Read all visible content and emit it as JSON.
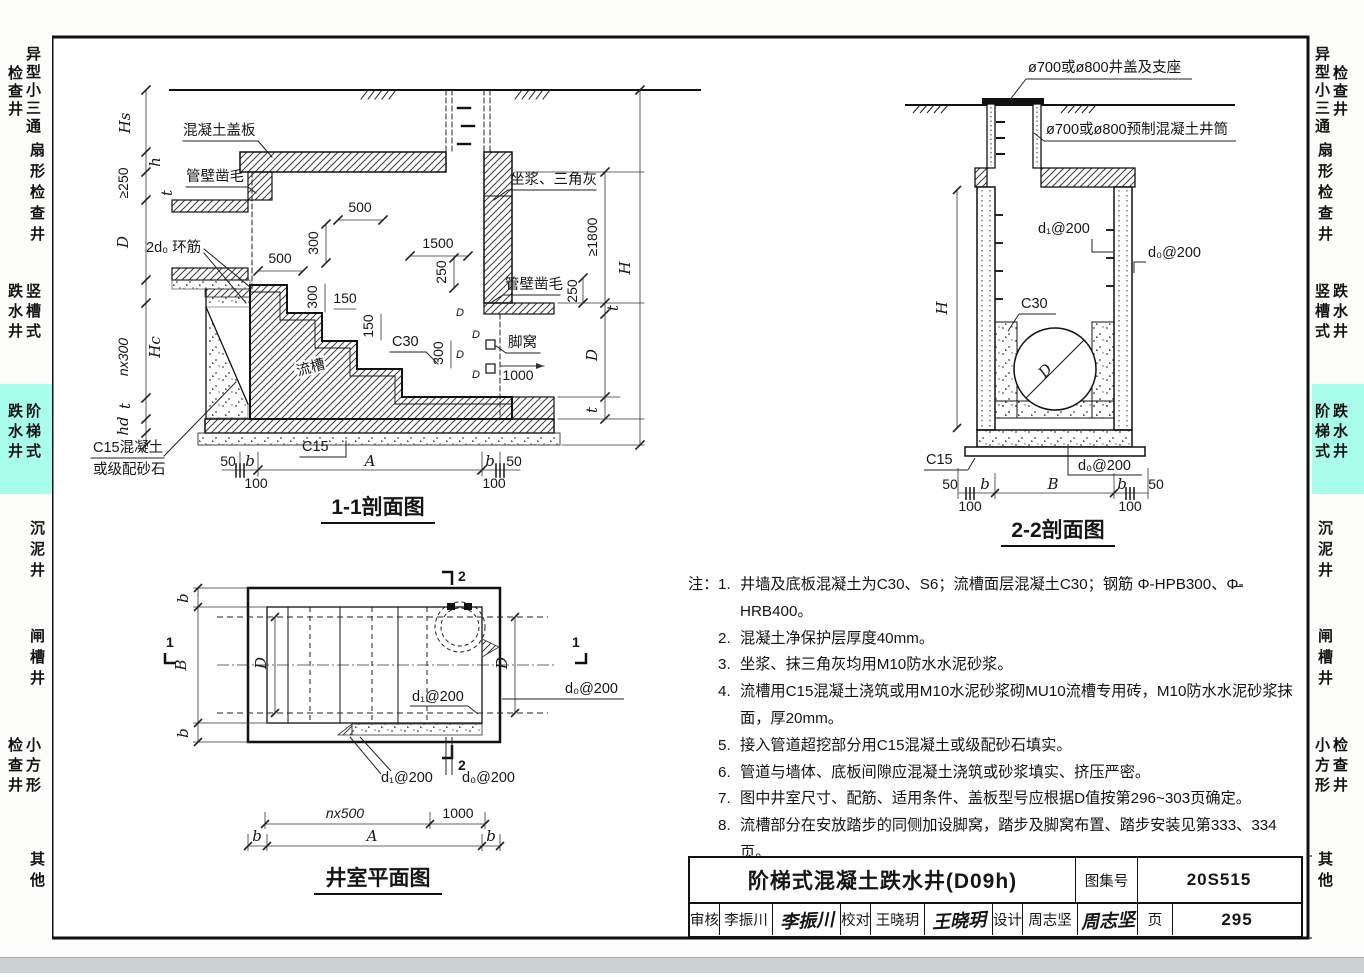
{
  "sidebar": {
    "highlight_color": "#a8fdeb",
    "groups": [
      {
        "inner": "异型小三通",
        "outer": "检查井"
      },
      {
        "inner": "扇形检查井",
        "outer": ""
      },
      {
        "inner": "竖槽式",
        "outer": "跌水井"
      },
      {
        "inner": "阶梯式",
        "outer": "跌水井"
      },
      {
        "inner": "沉泥井",
        "outer": ""
      },
      {
        "inner": "闸槽井",
        "outer": ""
      },
      {
        "inner": "小方形",
        "outer": "检查井"
      },
      {
        "inner": "其他",
        "outer": ""
      }
    ]
  },
  "dims": {
    "v50": "50",
    "v100": "100",
    "v150": "150",
    "v250": "250",
    "v300": "300",
    "v500": "500",
    "v1000": "1000",
    "v1500": "1500",
    "ge250": "≥250",
    "ge1800": "≥1800",
    "nx300": "nx300",
    "nx500": "nx500",
    "A": "A",
    "B": "B",
    "D": "D",
    "H": "H",
    "Hs": "Hs",
    "Hc": "Hc",
    "h": "h",
    "hd": "hd",
    "t": "t",
    "b": "b",
    "one": "1",
    "two": "2"
  },
  "s11": {
    "title": "1-1剖面图",
    "cover": "混凝土盖板",
    "chisel": "管壁凿毛",
    "ring": "2d₀ 环筋",
    "mortar": "坐浆、三角灰",
    "foothole": "脚窝",
    "channel": "流槽",
    "c30": "C30",
    "c15": "C15",
    "fill1": "C15混凝土",
    "fill2": "或级配砂石"
  },
  "s22": {
    "title": "2-2剖面图",
    "cap": "ø700或ø800井盖及支座",
    "tube": "ø700或ø800预制混凝土井筒",
    "c30": "C30",
    "c15": "C15",
    "d1": "d₁@200",
    "d0": "d₀@200"
  },
  "plan": {
    "title": "井室平面图",
    "d1": "d₁@200",
    "d0": "d₀@200"
  },
  "notes": {
    "heading": "注：",
    "items": [
      {
        "num": "1.",
        "text": "井墙及底板混凝土为C30、S6；流槽面层混凝土C30；钢筋 Φ-HPB300、Φ̶-HRB400。"
      },
      {
        "num": "2.",
        "text": "混凝土净保护层厚度40mm。"
      },
      {
        "num": "3.",
        "text": "坐浆、抹三角灰均用M10防水水泥砂浆。"
      },
      {
        "num": "4.",
        "text": "流槽用C15混凝土浇筑或用M10水泥砂浆砌MU10流槽专用砖，M10防水水泥砂浆抹面，厚20mm。"
      },
      {
        "num": "5.",
        "text": "接入管道超挖部分用C15混凝土或级配砂石填实。"
      },
      {
        "num": "6.",
        "text": "管道与墙体、底板间隙应混凝土浇筑或砂浆填实、挤压严密。"
      },
      {
        "num": "7.",
        "text": "图中井室尺寸、配筋、适用条件、盖板型号应根据D值按第296~303页确定。"
      },
      {
        "num": "8.",
        "text": "流槽部分在安放踏步的同侧加设脚窝，踏步及脚窝布置、踏步安装见第333、334页。"
      },
      {
        "num": "9.",
        "text": "其他要求详见总说明。"
      }
    ]
  },
  "titleblock": {
    "title": "阶梯式混凝土跌水井(D09h)",
    "atlas_label": "图集号",
    "atlas_no": "20S515",
    "page_label": "页",
    "page_no": "295",
    "review_label": "审核",
    "review_name": "李振川",
    "review_sig": "李振川",
    "proof_label": "校对",
    "proof_name": "王晓玥",
    "proof_sig": "王晓玥",
    "design_label": "设计",
    "design_name": "周志坚",
    "design_sig": "周志坚"
  }
}
